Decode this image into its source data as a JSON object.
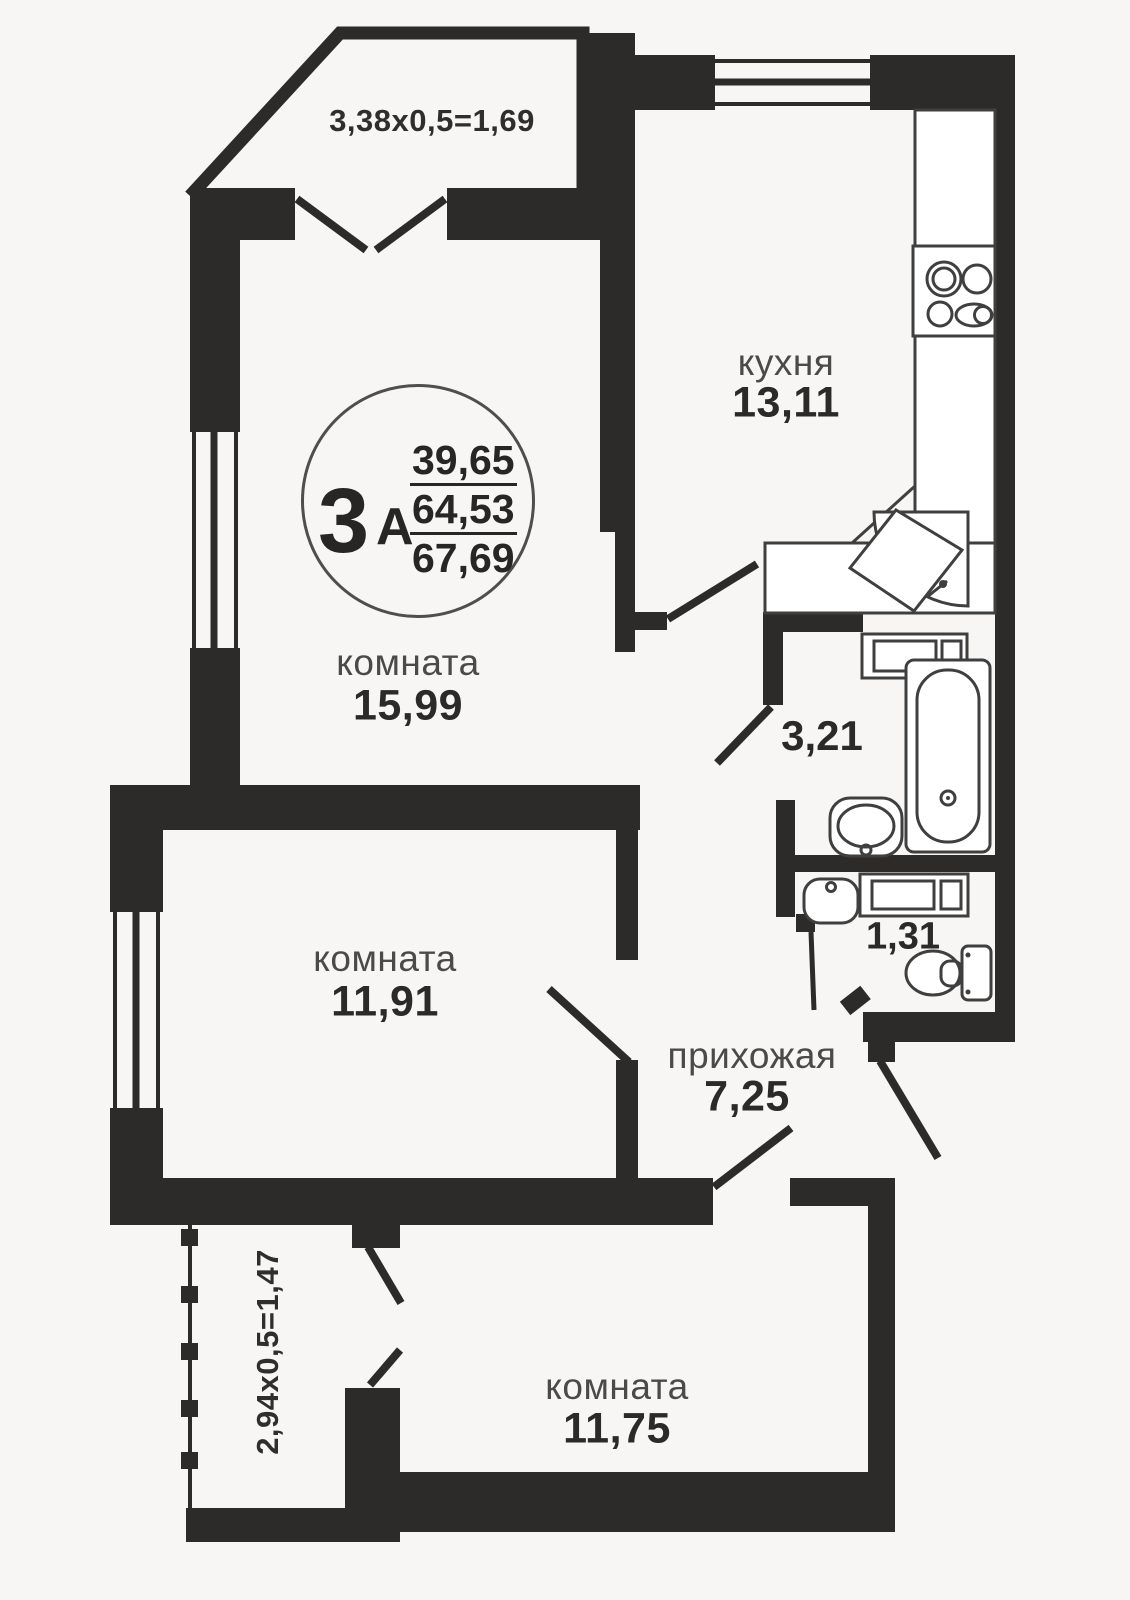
{
  "unit": {
    "rooms_count": "3",
    "type_letter": "А",
    "area_living": "39,65",
    "area_main": "64,53",
    "area_total": "67,69"
  },
  "rooms": {
    "kitchen": {
      "name": "кухня",
      "area": "13,11"
    },
    "living": {
      "name": "комната",
      "area": "15,99"
    },
    "bedroom": {
      "name": "комната",
      "area": "11,91"
    },
    "bedroom2": {
      "name": "комната",
      "area": "11,75"
    },
    "hallway": {
      "name": "прихожая",
      "area": "7,25"
    },
    "bathroom": {
      "area": "3,21"
    },
    "wc": {
      "area": "1,31"
    }
  },
  "balconies": {
    "top": {
      "dimensions": "3,38x0,5=1,69"
    },
    "bottom": {
      "dimensions": "2,94x0,5=1,47"
    }
  },
  "colors": {
    "wall": "#2d2b29",
    "background": "#f7f6f4",
    "fixture": "#3f3f3f"
  }
}
